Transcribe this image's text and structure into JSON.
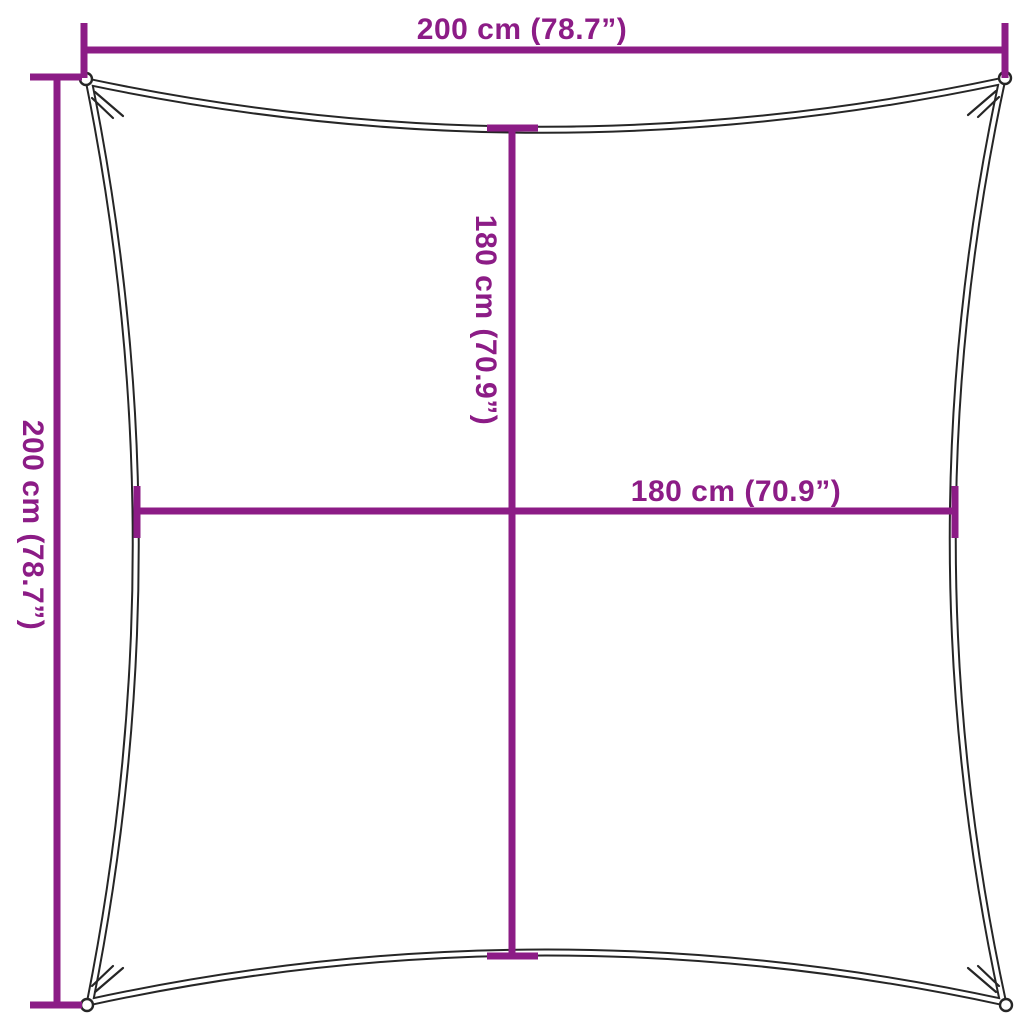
{
  "figure": {
    "name": "shade-sail-dimension-diagram",
    "description": "Square shade sail outline with concave edges, corner grommet rings and purple dimension lines"
  },
  "labels": {
    "top": "200 cm (78.7”)",
    "left": "200 cm (78.7”)",
    "inner_vertical": "180 cm (70.9”)",
    "inner_horizontal": "180 cm (70.9”)"
  },
  "sail_dimensions": {
    "overall_width": {
      "cm": 200,
      "inches": 78.7
    },
    "overall_height": {
      "cm": 200,
      "inches": 78.7
    },
    "inner_width": {
      "cm": 180,
      "inches": 70.9
    },
    "inner_height": {
      "cm": 180,
      "inches": 70.9
    }
  },
  "colors": {
    "accent": "#8C1C86",
    "outline": "#262626",
    "background": "#FFFFFF"
  }
}
